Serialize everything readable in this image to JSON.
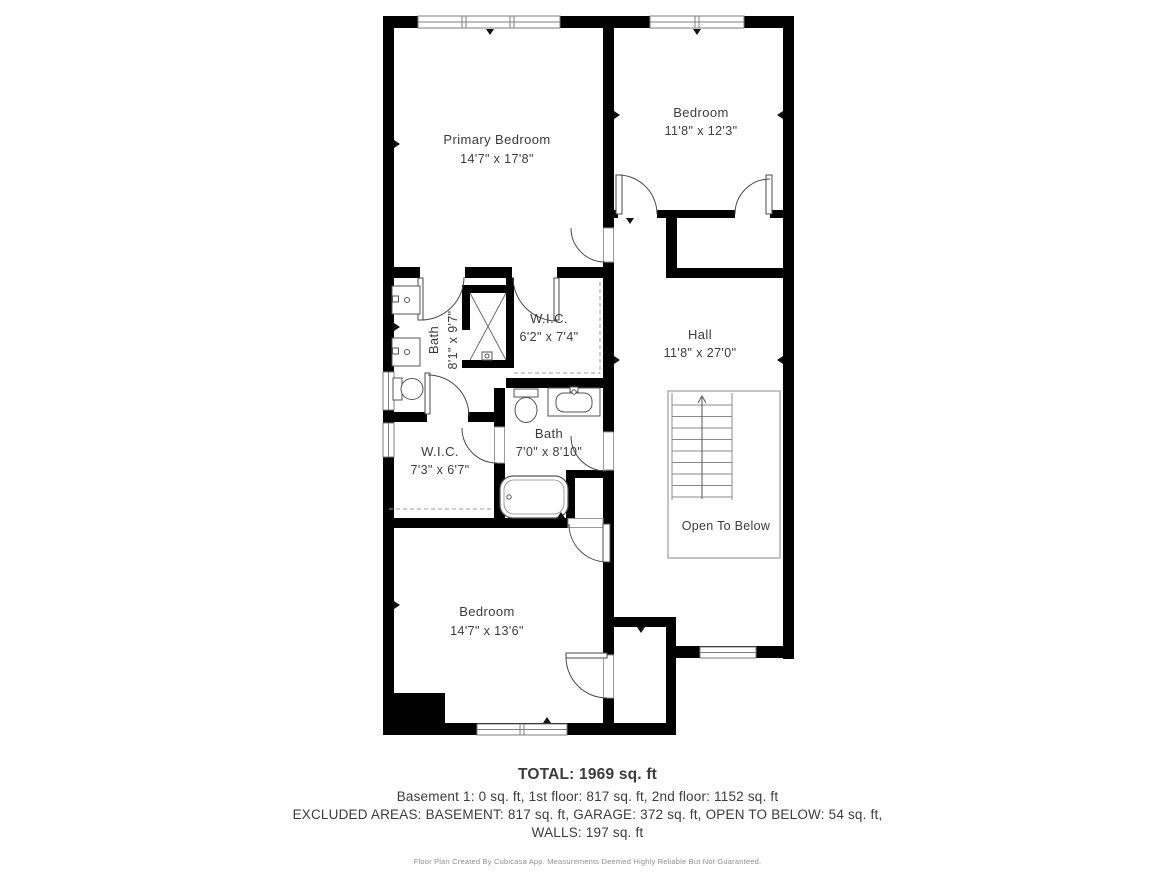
{
  "page": {
    "background": "#ffffff"
  },
  "plan": {
    "colors": {
      "wall": "#000000",
      "label": "#3b3b3b",
      "thin_line": "#8a8a8a"
    },
    "rooms": {
      "primary_bedroom": {
        "name": "Primary Bedroom",
        "dims": "14'7\" x 17'8\""
      },
      "bedroom_2": {
        "name": "Bedroom",
        "dims": "11'8\" x 12'3\""
      },
      "primary_bath": {
        "name": "Bath",
        "dims": "8'1\" x 9'7\""
      },
      "primary_wic": {
        "name": "W.I.C.",
        "dims": "6'2\" x 7'4\""
      },
      "hall": {
        "name": "Hall",
        "dims": "11'8\" x 27'0\""
      },
      "wic_2": {
        "name": "W.I.C.",
        "dims": "7'3\" x 6'7\""
      },
      "bath_2": {
        "name": "Bath",
        "dims": "7'0\" x 8'10\""
      },
      "bedroom_3": {
        "name": "Bedroom",
        "dims": "14'7\" x 13'6\""
      },
      "open_to_below": {
        "name": "Open To Below"
      }
    }
  },
  "summary": {
    "total": "TOTAL: 1969 sq. ft",
    "floors": "Basement 1: 0 sq. ft, 1st floor: 817 sq. ft, 2nd floor: 1152 sq. ft",
    "excluded": "EXCLUDED AREAS: BASEMENT: 817 sq. ft, GARAGE: 372 sq. ft, OPEN TO BELOW: 54 sq. ft,",
    "walls": "WALLS: 197 sq. ft",
    "disclaimer": "Floor Plan Created By Cubicasa App. Measurements Deemed Highly Reliable But Not Guaranteed."
  }
}
